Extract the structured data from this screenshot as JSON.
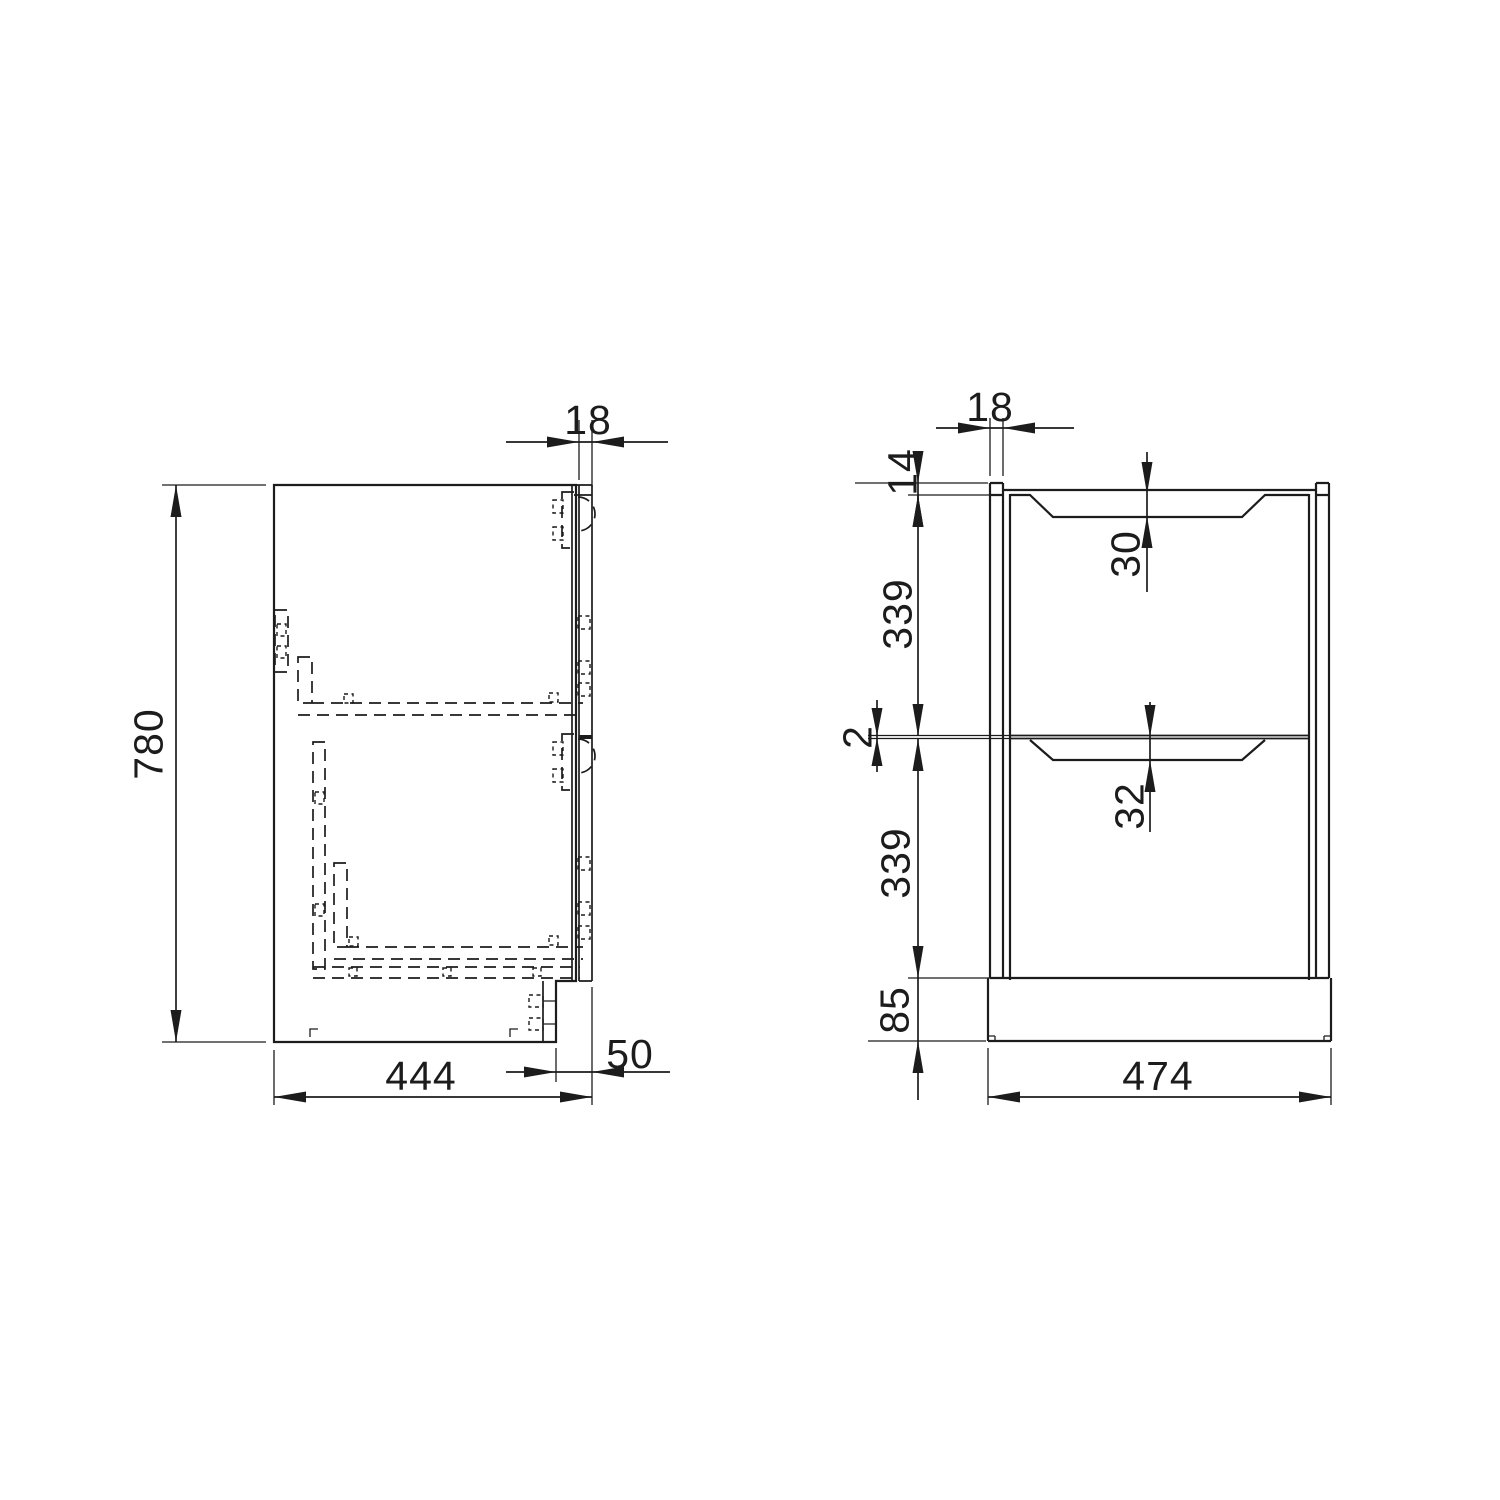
{
  "drawing_type": "cabinet technical drawing, two orthographic views",
  "views": {
    "side": {
      "height": "780",
      "front_thickness": "18",
      "depth": "444",
      "plinth_recess": "50"
    },
    "front": {
      "panel_thickness": "18",
      "top_reveal": "14",
      "drawer_upper_height": "339",
      "recess_upper": "30",
      "gap": "2",
      "recess_lower": "32",
      "drawer_lower_height": "339",
      "plinth_height": "85",
      "width": "474"
    }
  },
  "colors": {
    "line": "#1c1c1c",
    "background": "#ffffff"
  }
}
